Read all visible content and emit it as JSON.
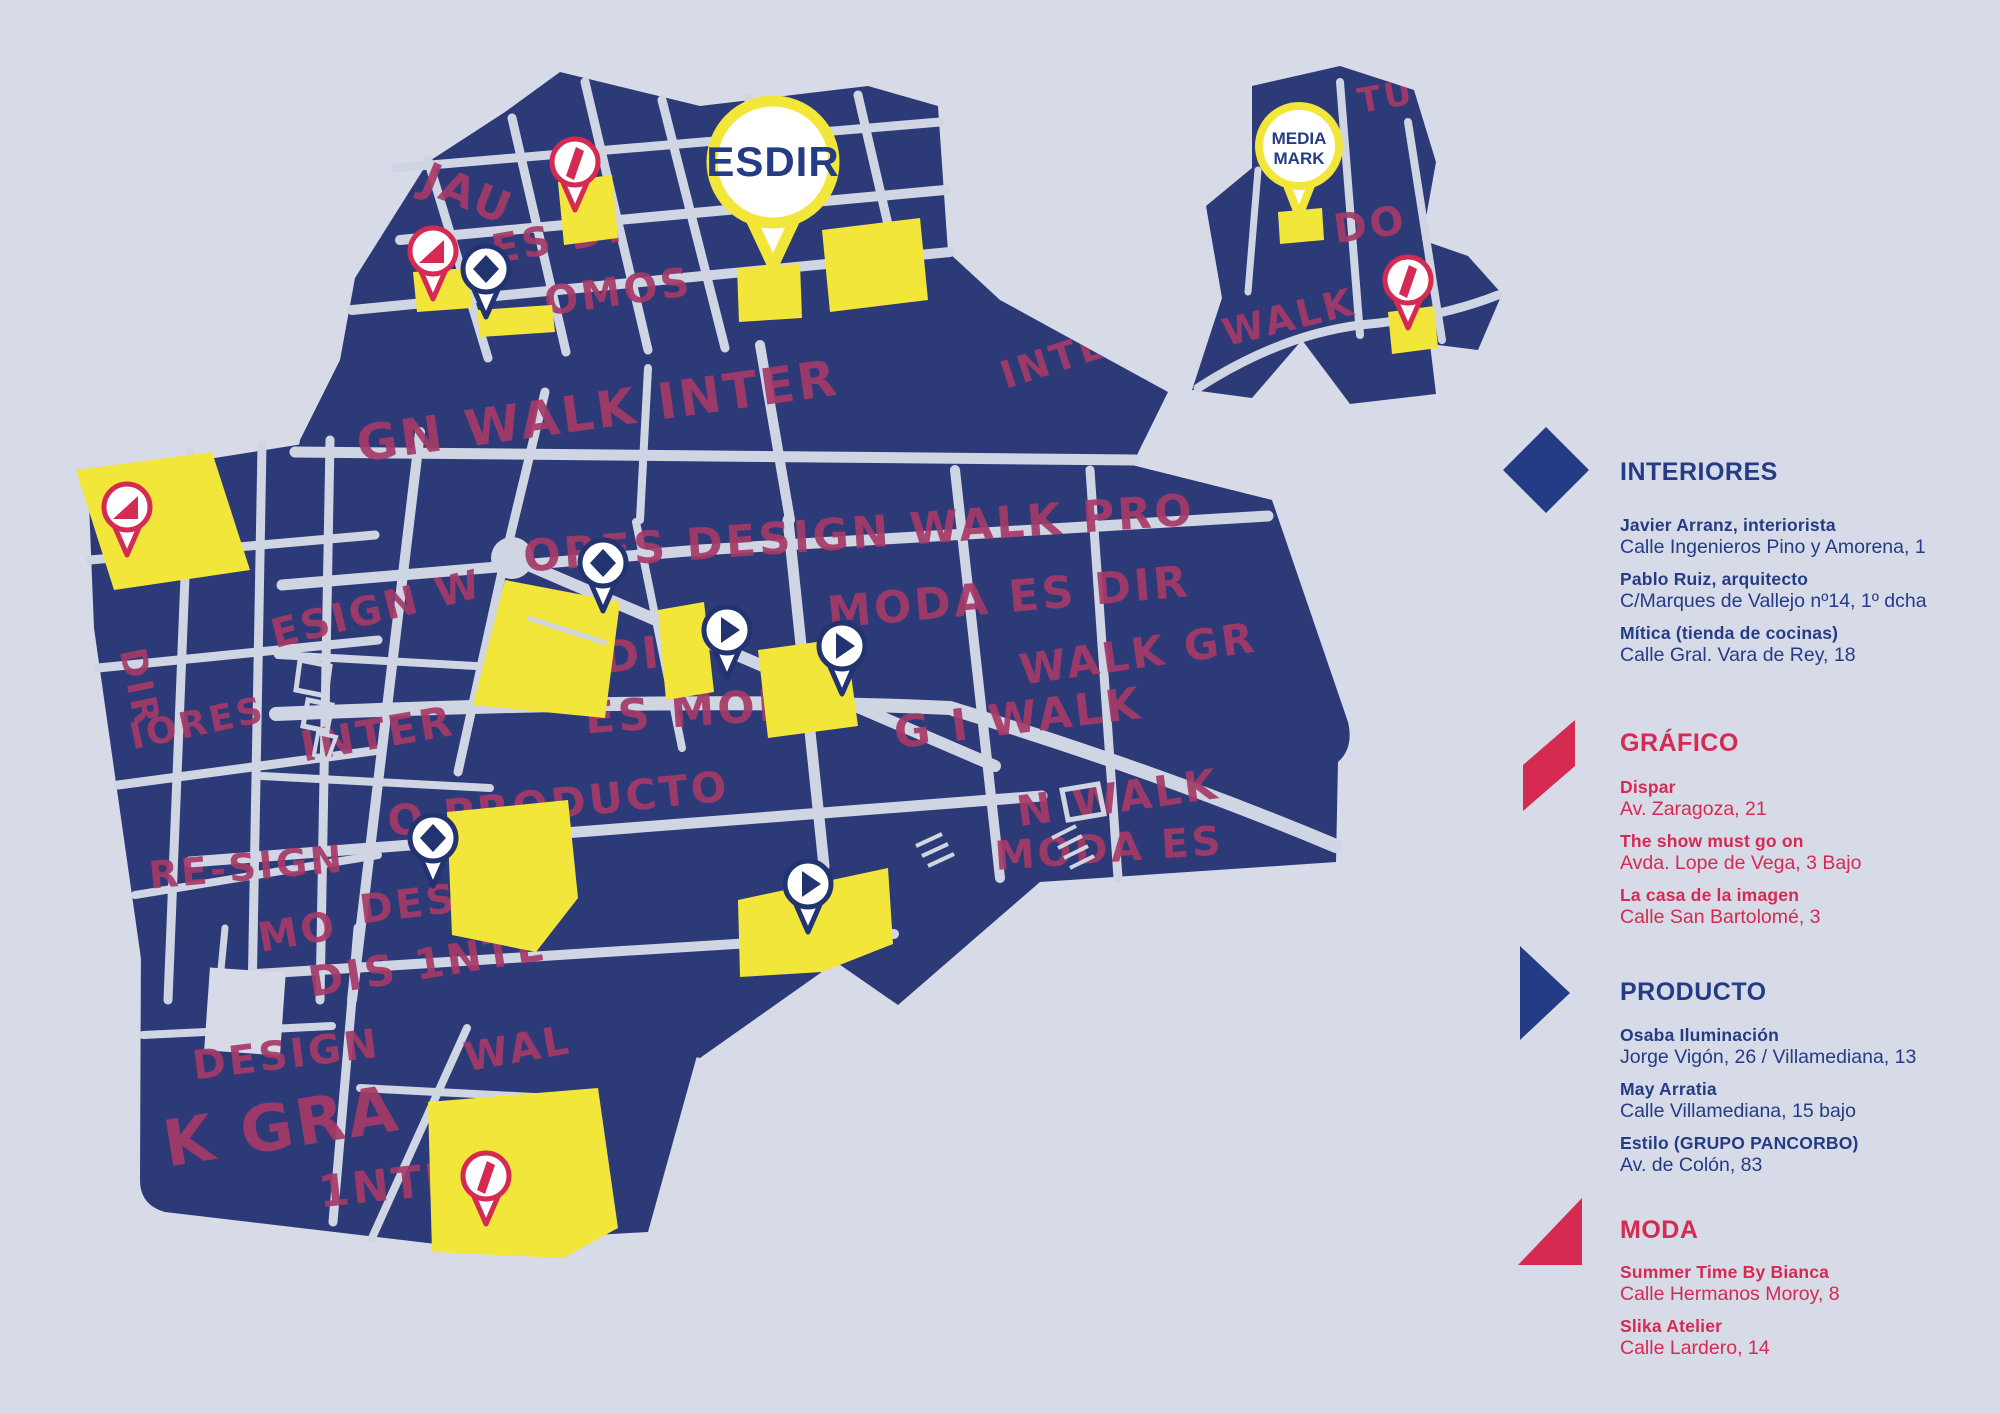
{
  "colors": {
    "background": "#d7dae7",
    "street": "#d0d5e3",
    "map_navy": "#2c3a78",
    "pin_navy": "#223470",
    "handwriting_crimson": "#a53a68",
    "accent_red": "#d52a52",
    "highlight_yellow": "#f2e63b",
    "legend_navy": "#233c85"
  },
  "map": {
    "esdir_pin_label": "ESDIR",
    "media_pin_label_line1": "MEDIA",
    "media_pin_label_line2": "MARK",
    "pins": [
      {
        "type": "grafico",
        "x": 575,
        "y": 162
      },
      {
        "type": "moda",
        "x": 433,
        "y": 251
      },
      {
        "type": "interiores",
        "x": 486,
        "y": 269
      },
      {
        "type": "media",
        "x": 1299,
        "y": 146
      },
      {
        "type": "grafico",
        "x": 1408,
        "y": 280
      },
      {
        "type": "moda",
        "x": 127,
        "y": 507
      },
      {
        "type": "interiores",
        "x": 603,
        "y": 563
      },
      {
        "type": "producto",
        "x": 727,
        "y": 630
      },
      {
        "type": "producto",
        "x": 842,
        "y": 646
      },
      {
        "type": "interiores",
        "x": 433,
        "y": 838
      },
      {
        "type": "producto",
        "x": 808,
        "y": 884
      },
      {
        "type": "grafico",
        "x": 486,
        "y": 1176
      },
      {
        "type": "esdir",
        "x": 773,
        "y": 162
      }
    ],
    "graffiti": [
      {
        "t": "ERIC",
        "x": 490,
        "y": 92,
        "r": -14,
        "s": 34
      },
      {
        "t": "JAU",
        "x": 462,
        "y": 208,
        "r": 22,
        "s": 44
      },
      {
        "t": "ES DI",
        "x": 560,
        "y": 252,
        "r": -10,
        "s": 40
      },
      {
        "t": "OMOS",
        "x": 620,
        "y": 305,
        "r": -8,
        "s": 40
      },
      {
        "t": "TU",
        "x": 1388,
        "y": 108,
        "r": -10,
        "s": 34
      },
      {
        "t": "ES I",
        "x": 1452,
        "y": 180,
        "r": 68,
        "s": 36
      },
      {
        "t": "DO",
        "x": 1372,
        "y": 238,
        "r": -8,
        "s": 40
      },
      {
        "t": "WALK",
        "x": 1292,
        "y": 330,
        "r": -14,
        "s": 38
      },
      {
        "t": "GN WALK INTER",
        "x": 600,
        "y": 428,
        "r": -8,
        "s": 50
      },
      {
        "t": "INTE",
        "x": 1058,
        "y": 372,
        "r": -18,
        "s": 38
      },
      {
        "t": "ORES DESIGN WALK PRO",
        "x": 860,
        "y": 548,
        "r": -4,
        "s": 44
      },
      {
        "t": "MODA ES DIR",
        "x": 1010,
        "y": 612,
        "r": -5,
        "s": 44
      },
      {
        "t": "DIR",
        "x": 652,
        "y": 668,
        "r": -6,
        "s": 44
      },
      {
        "t": "WALK GR",
        "x": 1140,
        "y": 668,
        "r": -8,
        "s": 42
      },
      {
        "t": "ES MOD",
        "x": 692,
        "y": 726,
        "r": -4,
        "s": 44
      },
      {
        "t": "G I WALK",
        "x": 1020,
        "y": 733,
        "r": -7,
        "s": 44
      },
      {
        "t": "N WALK",
        "x": 1120,
        "y": 812,
        "r": -8,
        "s": 42
      },
      {
        "t": "MODA ES",
        "x": 1110,
        "y": 862,
        "r": -4,
        "s": 40
      },
      {
        "t": "O PRODUCTO",
        "x": 560,
        "y": 818,
        "r": -6,
        "s": 42
      },
      {
        "t": "ESIGN W",
        "x": 380,
        "y": 622,
        "r": -14,
        "s": 40
      },
      {
        "t": "INTER",
        "x": 380,
        "y": 748,
        "r": -10,
        "s": 42
      },
      {
        "t": "RE-SIGN",
        "x": 248,
        "y": 880,
        "r": -5,
        "s": 38
      },
      {
        "t": "ES",
        "x": 152,
        "y": 528,
        "r": 10,
        "s": 38
      },
      {
        "t": "DIR",
        "x": 128,
        "y": 690,
        "r": 78,
        "s": 36
      },
      {
        "t": "IORES",
        "x": 200,
        "y": 735,
        "r": -12,
        "s": 36
      },
      {
        "t": "MO",
        "x": 300,
        "y": 945,
        "r": -10,
        "s": 40
      },
      {
        "t": "DIS 1NTE",
        "x": 430,
        "y": 978,
        "r": -9,
        "s": 42
      },
      {
        "t": "DESING",
        "x": 455,
        "y": 912,
        "r": -7,
        "s": 40
      },
      {
        "t": "DESIGN",
        "x": 288,
        "y": 1068,
        "r": -7,
        "s": 40
      },
      {
        "t": "WAL",
        "x": 520,
        "y": 1062,
        "r": -10,
        "s": 40
      },
      {
        "t": "K GRA",
        "x": 285,
        "y": 1148,
        "r": -9,
        "s": 64
      },
      {
        "t": "1NTER",
        "x": 408,
        "y": 1198,
        "r": -6,
        "s": 44
      }
    ]
  },
  "legend": {
    "sections": [
      {
        "title": "INTERIORES",
        "icon": "diamond-icon",
        "entries": [
          {
            "name": "Javier Arranz, interiorista",
            "address": "Calle Ingenieros Pino y Amorena, 1"
          },
          {
            "name": "Pablo Ruiz, arquitecto",
            "address": "C/Marques de Vallejo nº14, 1º dcha"
          },
          {
            "name": "Mítica (tienda de cocinas)",
            "address": "Calle Gral. Vara de Rey, 18"
          }
        ]
      },
      {
        "title": "GRÁFICO",
        "icon": "parallelogram-icon",
        "entries": [
          {
            "name": "Dispar",
            "address": "Av. Zaragoza, 21"
          },
          {
            "name": "The show must go on",
            "address": "Avda. Lope de Vega, 3 Bajo"
          },
          {
            "name": "La casa de la imagen",
            "address": "Calle San Bartolomé, 3"
          }
        ]
      },
      {
        "title": "PRODUCTO",
        "icon": "play-triangle-icon",
        "entries": [
          {
            "name": "Osaba Iluminación",
            "address": "Jorge Vigón, 26 / Villamediana, 13"
          },
          {
            "name": "May Arratia",
            "address": "Calle Villamediana, 15 bajo"
          },
          {
            "name": "Estilo (GRUPO PANCORBO)",
            "address": "Av. de Colón, 83"
          }
        ]
      },
      {
        "title": "MODA",
        "icon": "corner-triangle-icon",
        "entries": [
          {
            "name": "Summer Time By Bianca",
            "address": "Calle Hermanos Moroy, 8"
          },
          {
            "name": "Slika Atelier",
            "address": "Calle Lardero, 14"
          }
        ]
      }
    ]
  }
}
